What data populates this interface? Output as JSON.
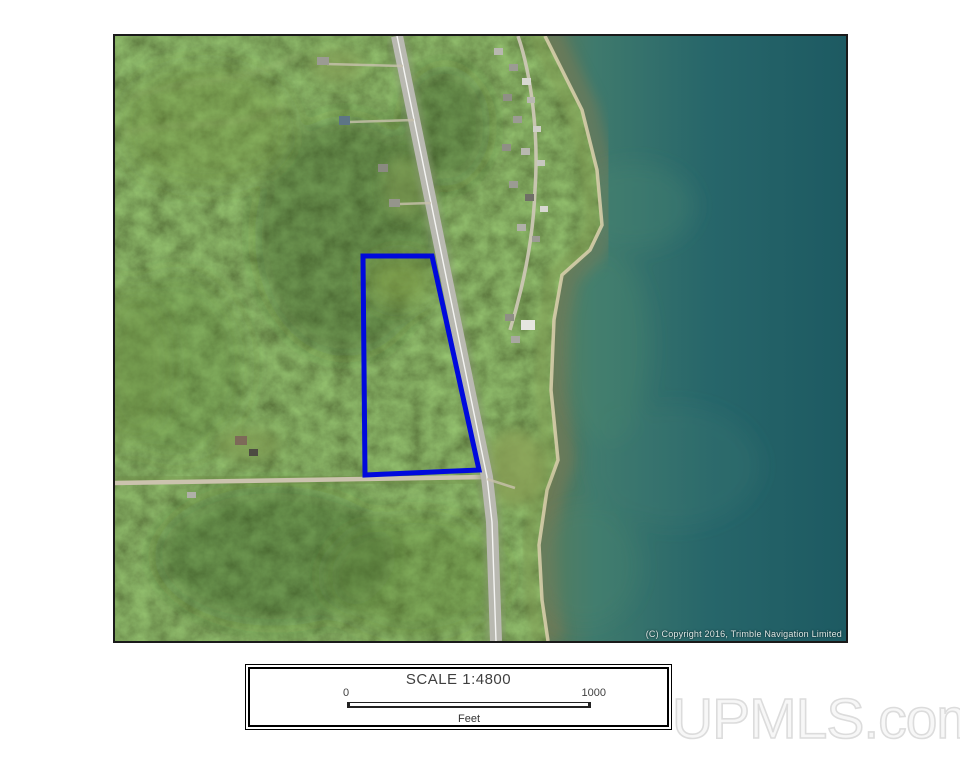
{
  "map": {
    "copyright": "(C) Copyright 2016, Trimble Navigation Limited",
    "parcel": {
      "points": "248,220 317,220 364,434 250,439",
      "color": "#0009dd",
      "stroke_width": "5"
    },
    "colors": {
      "forest": "#3a5b26",
      "forest_dark": "#22401a",
      "forest_light": "#7fa045",
      "water_deep": "#1d5a62",
      "water_mid": "#2f6e6a",
      "water_shallow": "#60795a",
      "shallow_band": "#7b7a54",
      "sand": "#d6cdaa",
      "highway": "#b9b9b1",
      "dirt_road": "#cbc3ae",
      "grass": "#7f9b52"
    }
  },
  "scale_panel": {
    "title": "SCALE 1:4800",
    "bar_start_label": "0",
    "bar_end_label": "1000",
    "unit_label": "Feet"
  },
  "watermark": {
    "text": "UPMLS.com"
  }
}
